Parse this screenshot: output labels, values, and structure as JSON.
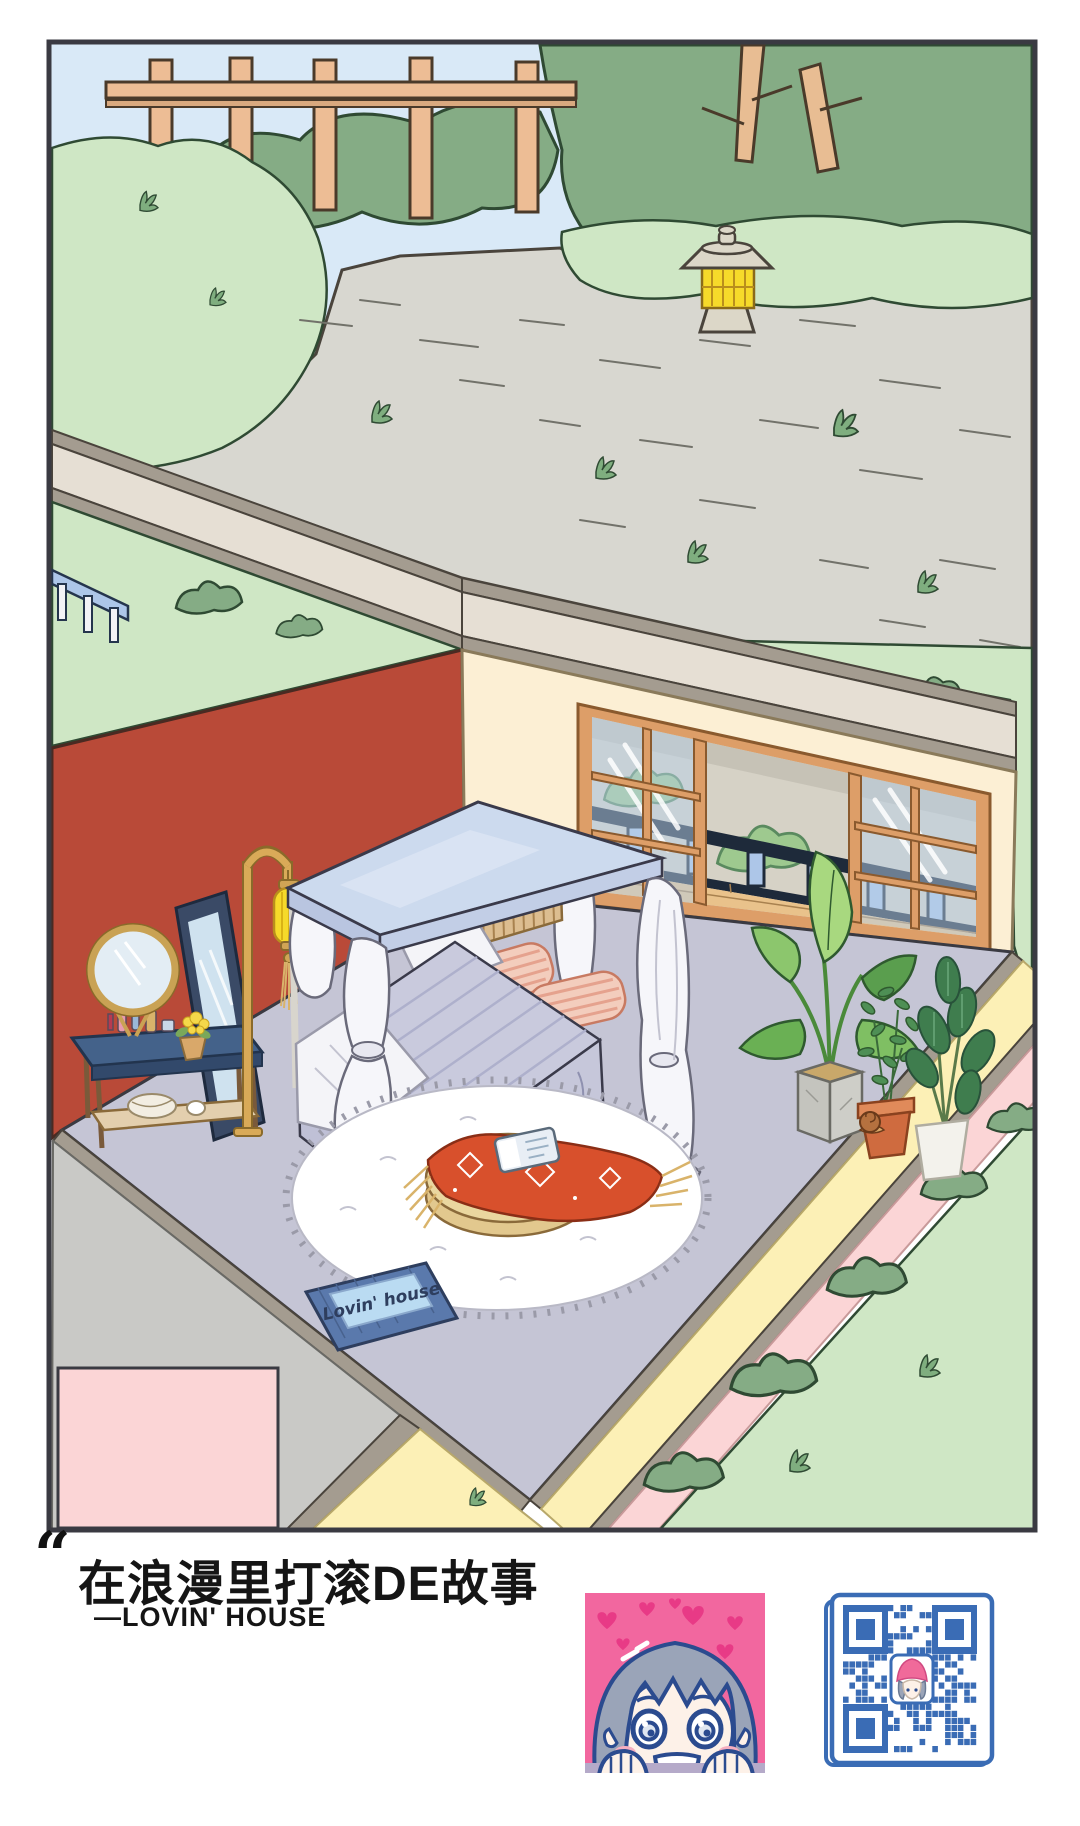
{
  "scene": {
    "doormat": {
      "text": "Lovin' house"
    }
  },
  "caption": {
    "quote_mark": "“",
    "title": "在浪漫里打滚DE故事",
    "byline": "—LOVIN' HOUSE"
  },
  "colors": {
    "sky": "#d9e9f7",
    "foliage_dark": "#85ac85",
    "grass_light": "#cfe7c5",
    "path_gray": "#d8d7d0",
    "wall_red": "#b94a38",
    "wall_cream": "#fcefd4",
    "floor_lavender": "#c5c5d5",
    "window_wood": "#dd9e68",
    "fence_wood": "#edbd95",
    "lantern_yellow": "#f6da2a",
    "canopy_blue": "#ccdaee",
    "blanket_red": "#d8502c",
    "mat_blue": "#5a79ac",
    "mat_band": "#badbf2",
    "wall_pink": "#fbd5d6",
    "walkway_yellow": "#fcf0b6",
    "qr_blue": "#3a6cb5",
    "avatar_pink": "#f2679f"
  }
}
